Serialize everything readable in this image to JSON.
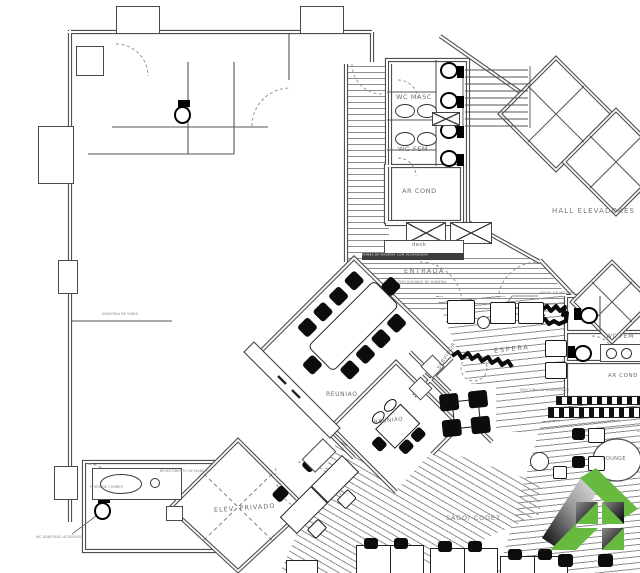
{
  "rooms": {
    "wc_masc": "WC MASC",
    "wc_fem_left": "WC FEM",
    "ar_cond_left": "AR COND",
    "hall": "HALL ELEVADORES",
    "entrada": "ENTRADA",
    "deck": "deck",
    "reuniao_a": "REUNIAO",
    "reuniao_b": "REUNIAO",
    "espera": "ESPERA",
    "servidor": "SERVIDOR",
    "wc_fem_right": "WC FEM",
    "ar_cond_right": "AR COND",
    "elev_privado": "ELEV. PRIVADO",
    "saguao": "SAGO/ CODE7",
    "lounge": "LOUNGE"
  },
  "annotations": {
    "painel": "PAINEL DE MADEIRA",
    "painel_strip": "PAINEL DE MADEIRA COM FECHADURAS",
    "entrada_sub": "PISO ELEVADO DE MADEIRA",
    "divisoria": "DIVISORIA DE VIDRO",
    "vinilico": "PISO VINILICO AMADEIRADO",
    "note1": "WC ADAPTADO ACESSIVEL",
    "note2": "REVESTIMENTO DE MADEIRA",
    "note3": "PORTA DE CORRER"
  },
  "colors": {
    "wall": "#4f4f4f",
    "hatch_line": "#8f8f8f",
    "text": "#6e6e6e",
    "chair": "#0c0c0c",
    "logo_green": "#68b93f",
    "logo_dark": "#1a1a1a"
  }
}
